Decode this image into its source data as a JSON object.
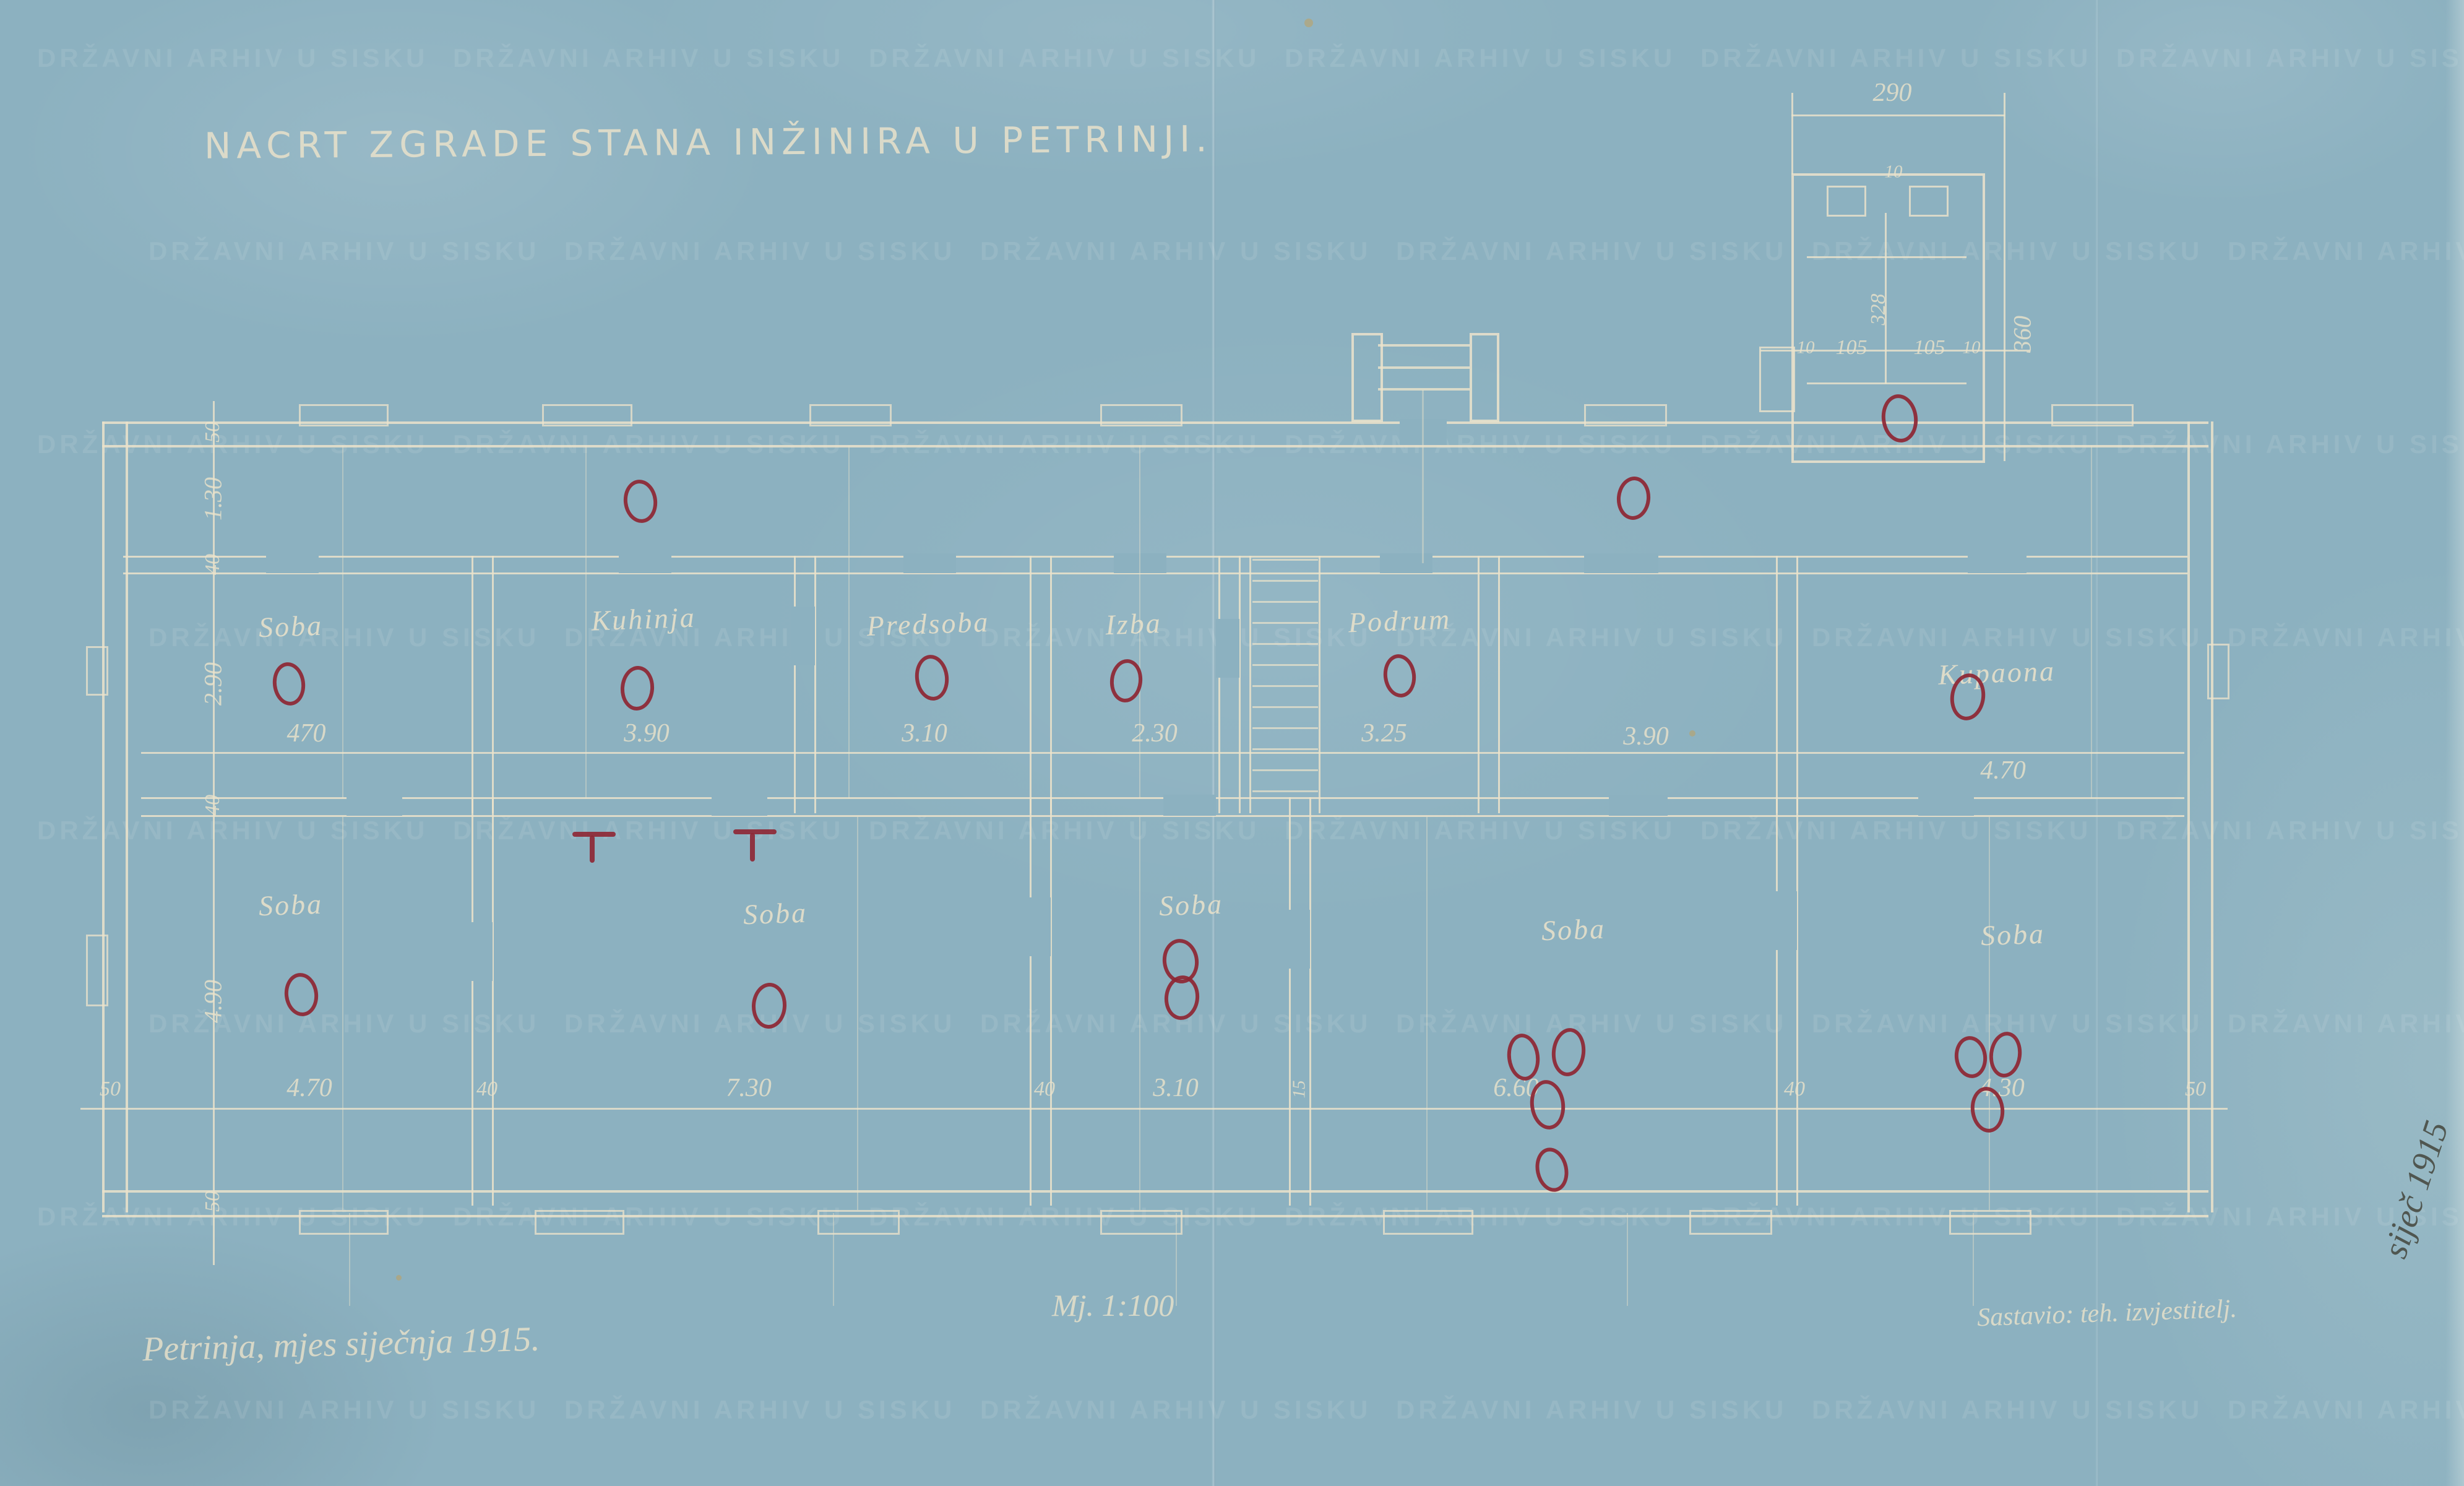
{
  "document": {
    "title": "NACRT ZGRADE STANA INŽINIRA U PETRINJI.",
    "place_date": "Petrinja, mjes siječnja 1915.",
    "scale_note": "Mj. 1:100",
    "author_note": "Sastavio: teh. izvjestitelj.",
    "margin_note": "siječ 1915",
    "watermark": "DRŽAVNI ARHIV U SISKU"
  },
  "rooms": {
    "top": [
      "Soba",
      "Kuhinja",
      "Predsoba",
      "Izba",
      "Podrum",
      "Kupaona"
    ],
    "bottom": [
      "Soba",
      "Soba",
      "Soba",
      "Soba",
      "Soba"
    ]
  },
  "dims": {
    "top_chain": [
      "470",
      "3.90",
      "3.10",
      "2.30",
      "3.25",
      "3.90",
      "4.70"
    ],
    "bottom_chain": [
      "50",
      "4.70",
      "40",
      "7.30",
      "40",
      "3.10",
      "6.60",
      "40",
      "4.30",
      "50"
    ],
    "left_chain": [
      "50",
      "1.30",
      "40",
      "2.90",
      "40",
      "4.90",
      "50"
    ],
    "stair_wall": "15",
    "annex": {
      "width": "290",
      "height": "360",
      "inner": [
        "10",
        "105",
        "105",
        "10"
      ],
      "depth": "328",
      "jamb": "10"
    }
  },
  "annotations": {
    "red_circles": 20,
    "red_t_marks": 2,
    "note": "hand-drawn red ink ovals marking stove positions"
  },
  "colors": {
    "paper": "#8cb1c0",
    "line": "#ece3cb",
    "red": "#8e2633",
    "pencil": "#44463c"
  }
}
